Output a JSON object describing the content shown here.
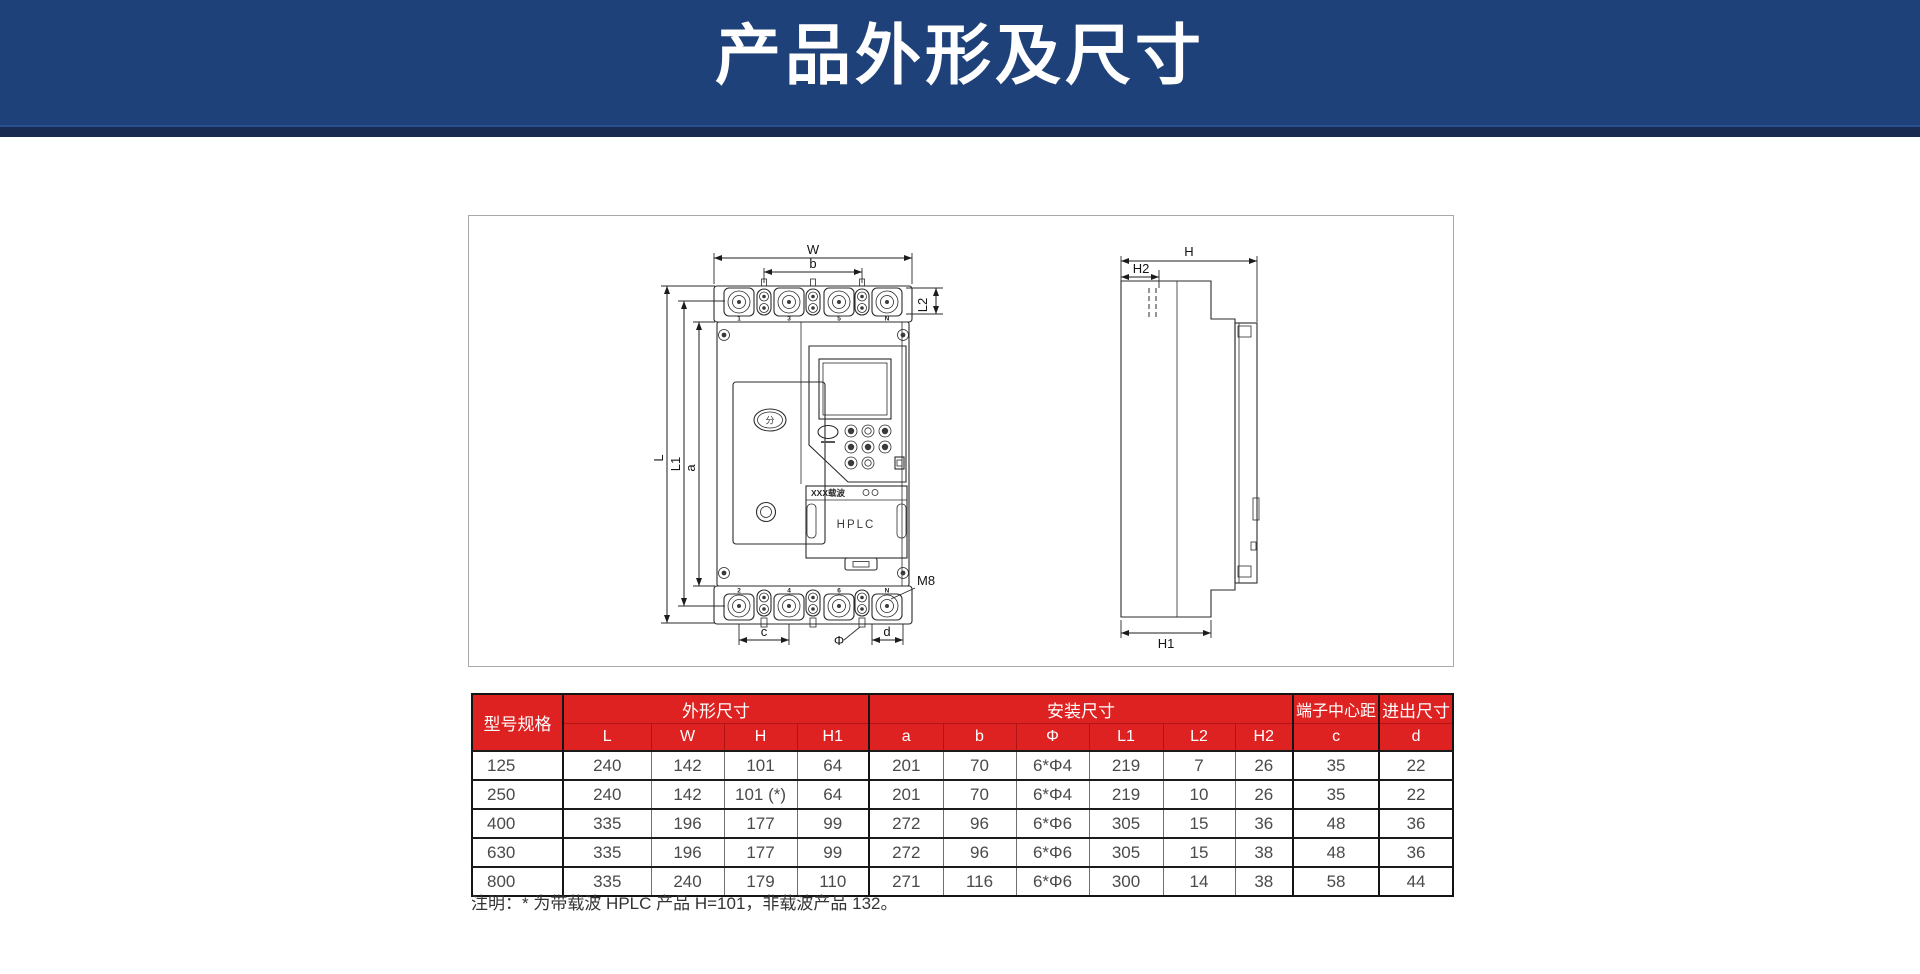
{
  "page": {
    "title": "产品外形及尺寸"
  },
  "diagram": {
    "front": {
      "dim_w": "W",
      "dim_b": "b",
      "dim_l": "L",
      "dim_l1": "L1",
      "dim_a": "a",
      "dim_l2": "L2",
      "dim_c": "c",
      "dim_phi": "Φ",
      "dim_d": "d",
      "thread_label": "M8",
      "top_terminals": [
        "1",
        "3",
        "5",
        "N"
      ],
      "bottom_terminals": [
        "2",
        "4",
        "6",
        "N"
      ],
      "carrier_label": "XXX载波",
      "module_label": "HPLC",
      "logo_glyph": "分"
    },
    "side": {
      "dim_h": "H",
      "dim_h2": "H2",
      "dim_h1": "H1"
    }
  },
  "table": {
    "header": {
      "model": "型号规格",
      "outline": "外形尺寸",
      "mounting": "安装尺寸",
      "terminal_pitch": "端子中心距",
      "inout": "进出尺寸",
      "sub": [
        "L",
        "W",
        "H",
        "H1",
        "a",
        "b",
        "Φ",
        "L1",
        "L2",
        "H2",
        "c",
        "d"
      ]
    },
    "rows": [
      {
        "model": "125",
        "values": [
          "240",
          "142",
          "101",
          "64",
          "201",
          "70",
          "6*Φ4",
          "219",
          "7",
          "26",
          "35",
          "22"
        ]
      },
      {
        "model": "250",
        "values": [
          "240",
          "142",
          "101 (*)",
          "64",
          "201",
          "70",
          "6*Φ4",
          "219",
          "10",
          "26",
          "35",
          "22"
        ]
      },
      {
        "model": "400",
        "values": [
          "335",
          "196",
          "177",
          "99",
          "272",
          "96",
          "6*Φ6",
          "305",
          "15",
          "36",
          "48",
          "36"
        ]
      },
      {
        "model": "630",
        "values": [
          "335",
          "196",
          "177",
          "99",
          "272",
          "96",
          "6*Φ6",
          "305",
          "15",
          "38",
          "48",
          "36"
        ]
      },
      {
        "model": "800",
        "values": [
          "335",
          "240",
          "179",
          "110",
          "271",
          "116",
          "6*Φ6",
          "300",
          "14",
          "38",
          "58",
          "44"
        ]
      }
    ]
  },
  "note": "注明：* 为带载波 HPLC 产品 H=101，非载波产品 132。",
  "colors": {
    "banner_blue": "#1e4179",
    "banner_strip": "#1a2b52",
    "table_header_red": "#de2121",
    "table_header_divider": "#b21414",
    "drawing_border": "#a8a8a8"
  }
}
